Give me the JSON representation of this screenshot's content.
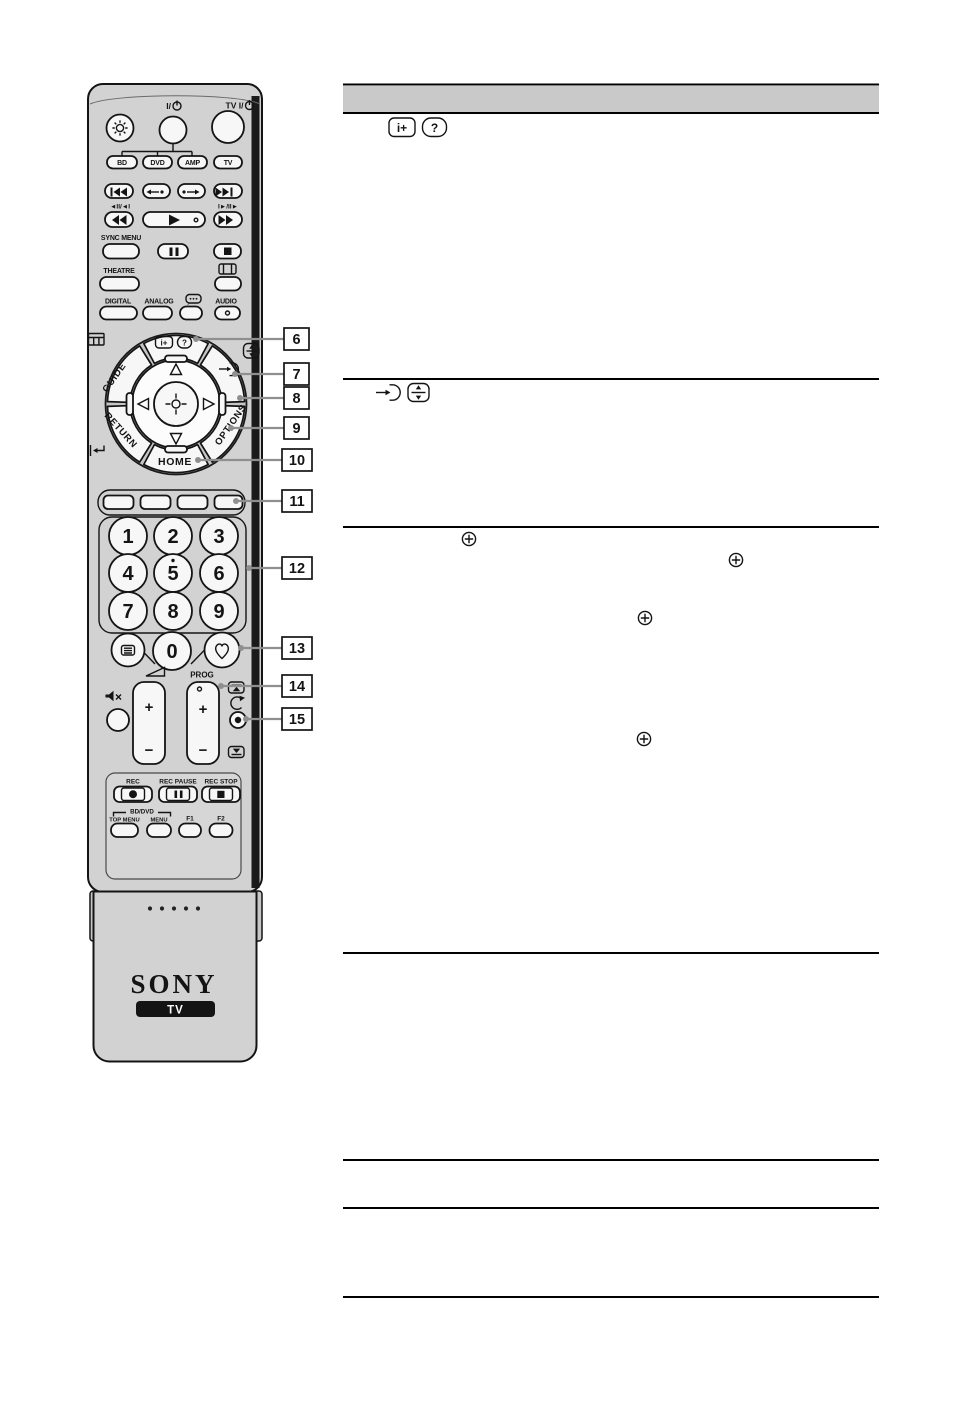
{
  "document": {
    "type": "remote-control-reference-page"
  },
  "colors": {
    "background": "#ffffff",
    "ink": "#141414",
    "remote_body": "#d2d2d2",
    "button_fill": "#f7f7f7",
    "table_header": "#c9c9c9",
    "leader_line": "#8f8f8f"
  },
  "remote": {
    "brand": "SONY",
    "badge": "TV",
    "power_label": "I/",
    "tv_power_label": "TV I/",
    "device_buttons": [
      "BD",
      "DVD",
      "AMP",
      "TV"
    ],
    "trick_left": "◄II/◄I",
    "trick_right": "I►/II►",
    "sync_menu": "SYNC MENU",
    "theatre": "THEATRE",
    "digital": "DIGITAL",
    "analog": "ANALOG",
    "audio": "AUDIO",
    "guide": "GUIDE",
    "return_label": "RETURN",
    "options": "OPTIONS",
    "home": "HOME",
    "info_icon_text": "i+",
    "help_icon_text": "?",
    "digits": [
      "1",
      "2",
      "3",
      "4",
      "5",
      "6",
      "7",
      "8",
      "9",
      "0"
    ],
    "prog": "PROG",
    "plus": "+",
    "minus": "−",
    "rec": "REC",
    "rec_pause": "REC PAUSE",
    "rec_stop": "REC STOP",
    "bd_dvd": "BD/DVD",
    "top_menu": "TOP MENU",
    "menu": "MENU",
    "f1": "F1",
    "f2": "F2"
  },
  "callouts": {
    "numbers": [
      "6",
      "7",
      "8",
      "9",
      "10",
      "11",
      "12",
      "13",
      "14",
      "15"
    ]
  },
  "table": {
    "header_text": "",
    "row1": {
      "info_icon_text": "i+",
      "help_icon_text": "?"
    },
    "icons": [
      "info-plus-icon",
      "help-icon",
      "input-select-icon",
      "screen-position-icon",
      "confirm-icon",
      "confirm-icon",
      "confirm-icon",
      "confirm-icon"
    ]
  }
}
